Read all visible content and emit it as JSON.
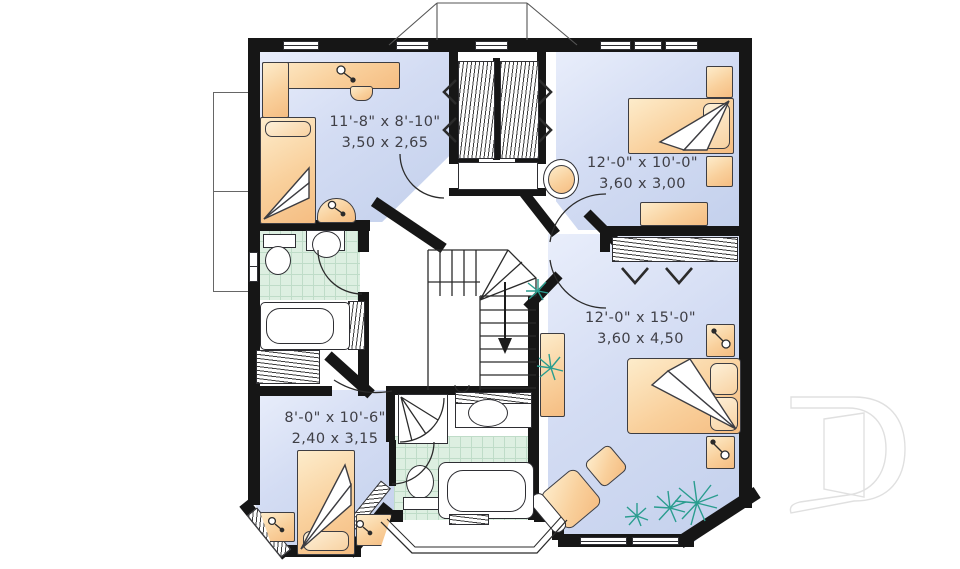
{
  "plan": {
    "type": "second-floor-plan",
    "rooms": [
      {
        "name": "bedroom-top-left",
        "imperial": "11'-8\" x 8'-10\"",
        "metric": "3,50 x 2,65"
      },
      {
        "name": "bedroom-top-right",
        "imperial": "12'-0\" x 10'-0\"",
        "metric": "3,60 x 3,00"
      },
      {
        "name": "bedroom-right",
        "imperial": "12'-0\" x 15'-0\"",
        "metric": "3,60 x 4,50"
      },
      {
        "name": "bedroom-bottom-left",
        "imperial": "8'-0\" x 10'-6\"",
        "metric": "2,40 x 3,15"
      }
    ],
    "watermark": {
      "letter": "D"
    },
    "colors": {
      "wall": "#161616",
      "room_fill": "#ccd7f0",
      "furniture": "#f7c68c",
      "bathroom_tile": "#ddefe1",
      "plant": "#2a9d8f",
      "watermark": "#e0e0e0"
    },
    "icons": {
      "plant-icon": "starburst",
      "lamp-icon": "circle-with-stem",
      "stair-arrow-icon": "down-arrow",
      "bifold-door-icon": "chevron"
    }
  }
}
